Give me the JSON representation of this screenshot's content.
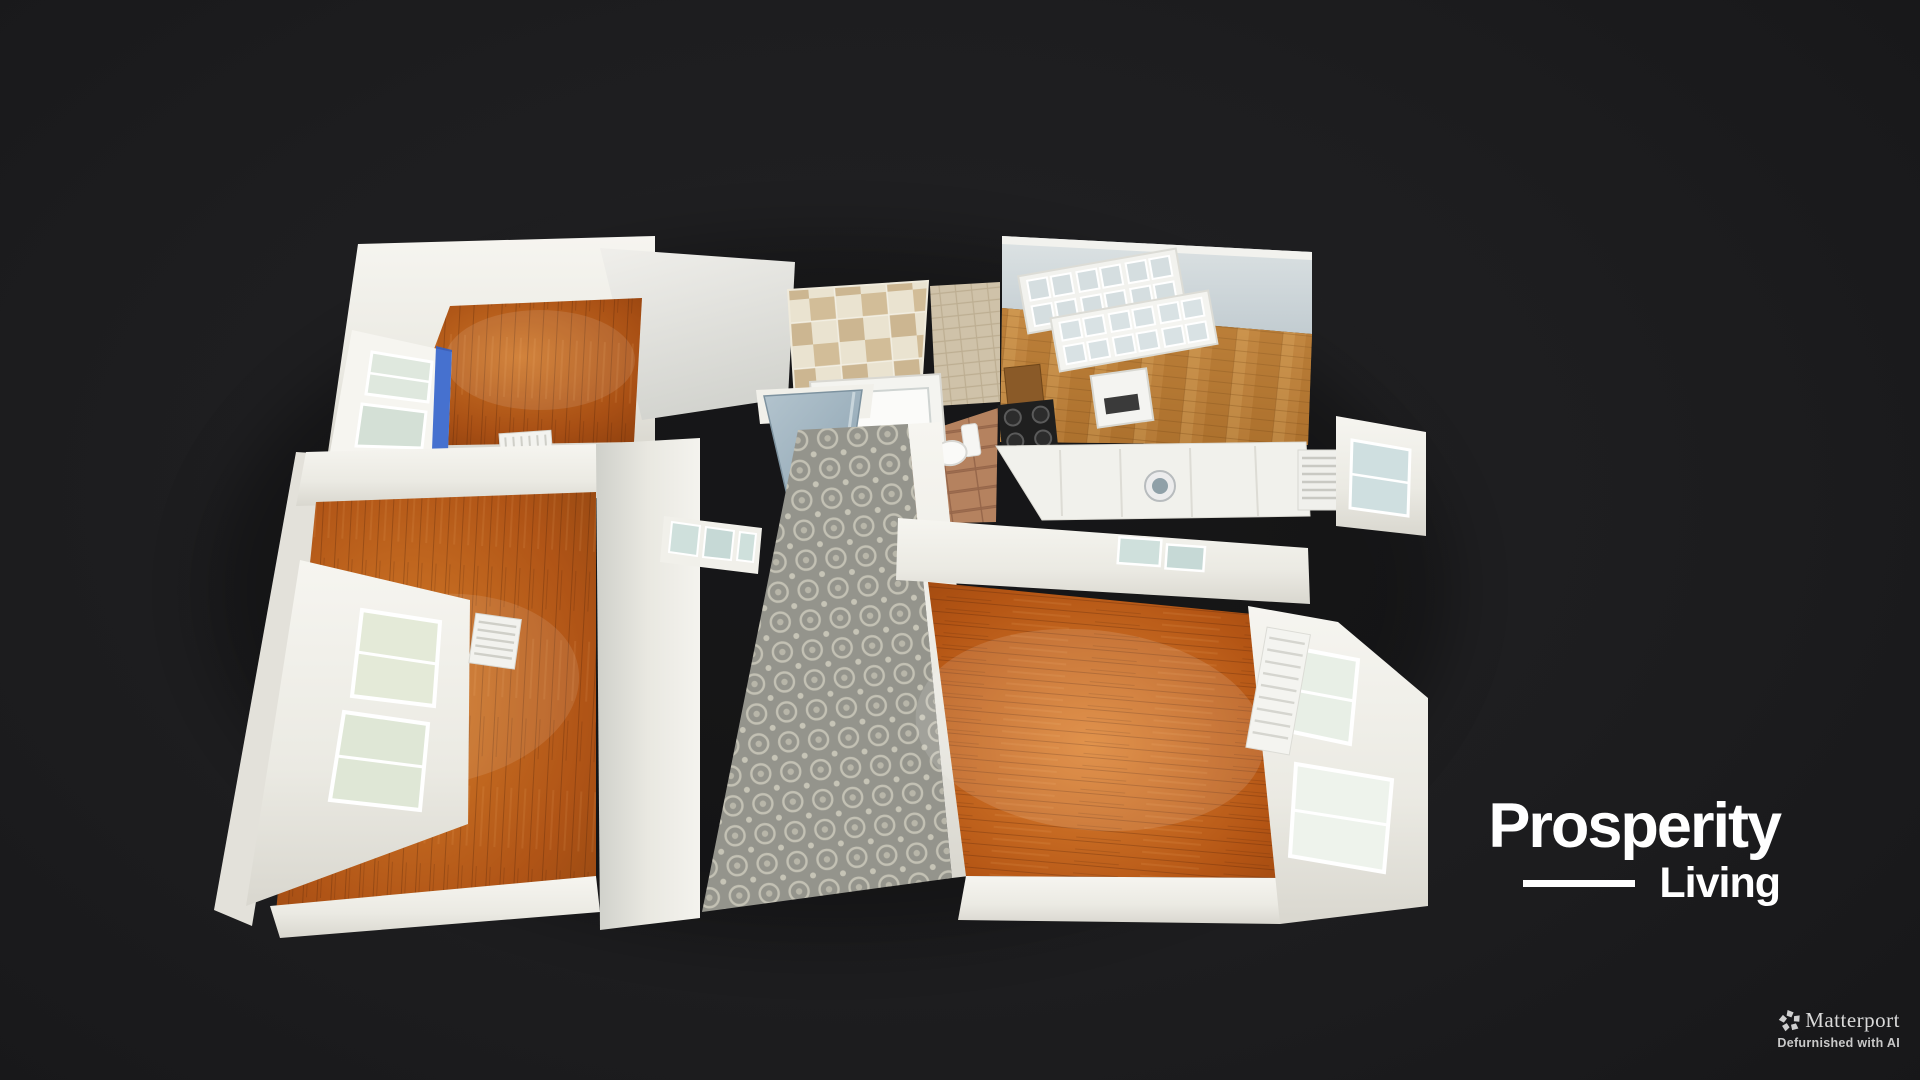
{
  "viewer": {
    "type": "matterport-3d-showcase",
    "view_mode": "dollhouse-top-down",
    "background_color": "#1d1d1f"
  },
  "floorplan": {
    "rooms": [
      {
        "id": "bedroom-top-left",
        "floor": "hardwood",
        "floor_color": "#ad5517",
        "features": [
          "window-with-blue-curtain",
          "radiator"
        ]
      },
      {
        "id": "bathroom",
        "floor": "terracotta-tile",
        "floor_color": "#b5825f",
        "features": [
          "checkered-tile-surface",
          "bathtub",
          "toilet"
        ]
      },
      {
        "id": "kitchen",
        "floor": "oak-parquet",
        "floor_color": "#c08440",
        "features": [
          "glass-front-upper-cabinets",
          "sink",
          "dark-hob",
          "counter-run",
          "washing-machine",
          "window",
          "radiator"
        ]
      },
      {
        "id": "bedroom-bottom-left",
        "floor": "hardwood",
        "floor_color": "#b05416",
        "features": [
          "double-window-bay",
          "radiator",
          "transom-glass"
        ]
      },
      {
        "id": "hallway",
        "floor": "patterned-mosaic-tile",
        "floor_color": "#94948c",
        "features": [
          "open-door"
        ]
      },
      {
        "id": "living-room",
        "floor": "hardwood",
        "floor_color": "#b45514",
        "features": [
          "window-bay",
          "shuttered-panel",
          "transom-glass"
        ]
      }
    ],
    "wall_color": "#f0efe9",
    "accent_blue": "#2e5ec9",
    "door_color": "#a3b7c3"
  },
  "brand": {
    "line1": "Prosperity",
    "line2": "Living",
    "color": "#ffffff"
  },
  "attribution": {
    "icon": "matterport-pinwheel-icon",
    "name": "Matterport",
    "tagline": "Defurnished with AI",
    "name_color": "#d9d9d9",
    "tagline_color": "#c9c9c9"
  }
}
